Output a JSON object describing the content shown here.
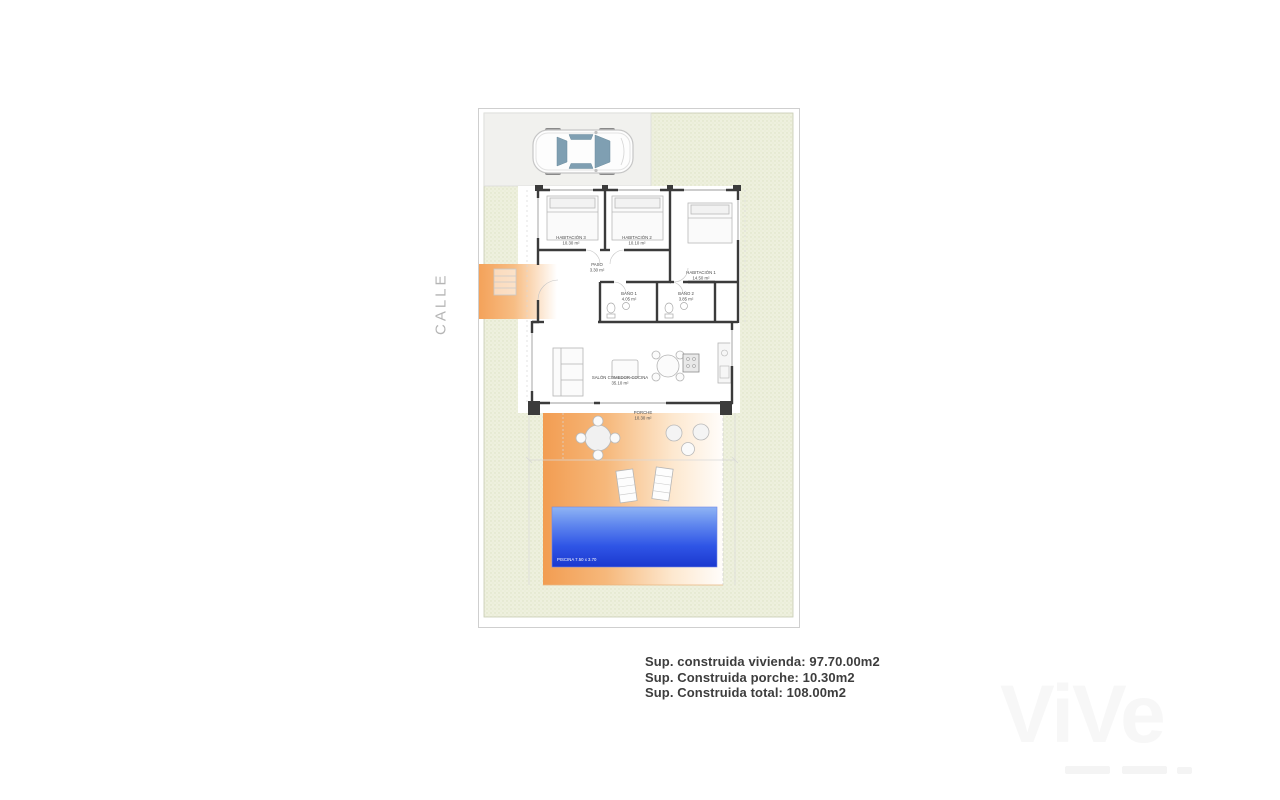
{
  "street_label": "CALLE",
  "watermark": "ViVe",
  "plan": {
    "rooms": {
      "hab3": {
        "name": "HABITACIÓN 3",
        "area": "10.30 m²"
      },
      "hab2": {
        "name": "HABITACIÓN 2",
        "area": "10.10 m²"
      },
      "hab1": {
        "name": "HABITACIÓN 1",
        "area": "14.50 m²"
      },
      "paso": {
        "name": "PASO",
        "area": "3.30 m²"
      },
      "bano1": {
        "name": "BAÑO 1",
        "area": "4.05 m²"
      },
      "bano2": {
        "name": "BAÑO 2",
        "area": "3.85 m²"
      },
      "salon": {
        "name": "SALÓN COMEDOR-COCINA",
        "area": "35.10 m²"
      },
      "porche": {
        "name": "PORCHE",
        "area": "10.30 m²"
      }
    },
    "pool_label": "PISCINA 7.50 x 3.70"
  },
  "summary": {
    "vivienda": "Sup. construida vivienda: 97.70.00m2",
    "porche": "Sup. Construida porche: 10.30m2",
    "total": "Sup. Construida total: 108.00m2"
  },
  "colors": {
    "terrace_orange": "#f4a35c",
    "pool_blue_light": "#8fb4f4",
    "pool_blue_dark": "#1b38cf",
    "garden_green": "#eef0de",
    "wall": "#3b3b3b"
  }
}
